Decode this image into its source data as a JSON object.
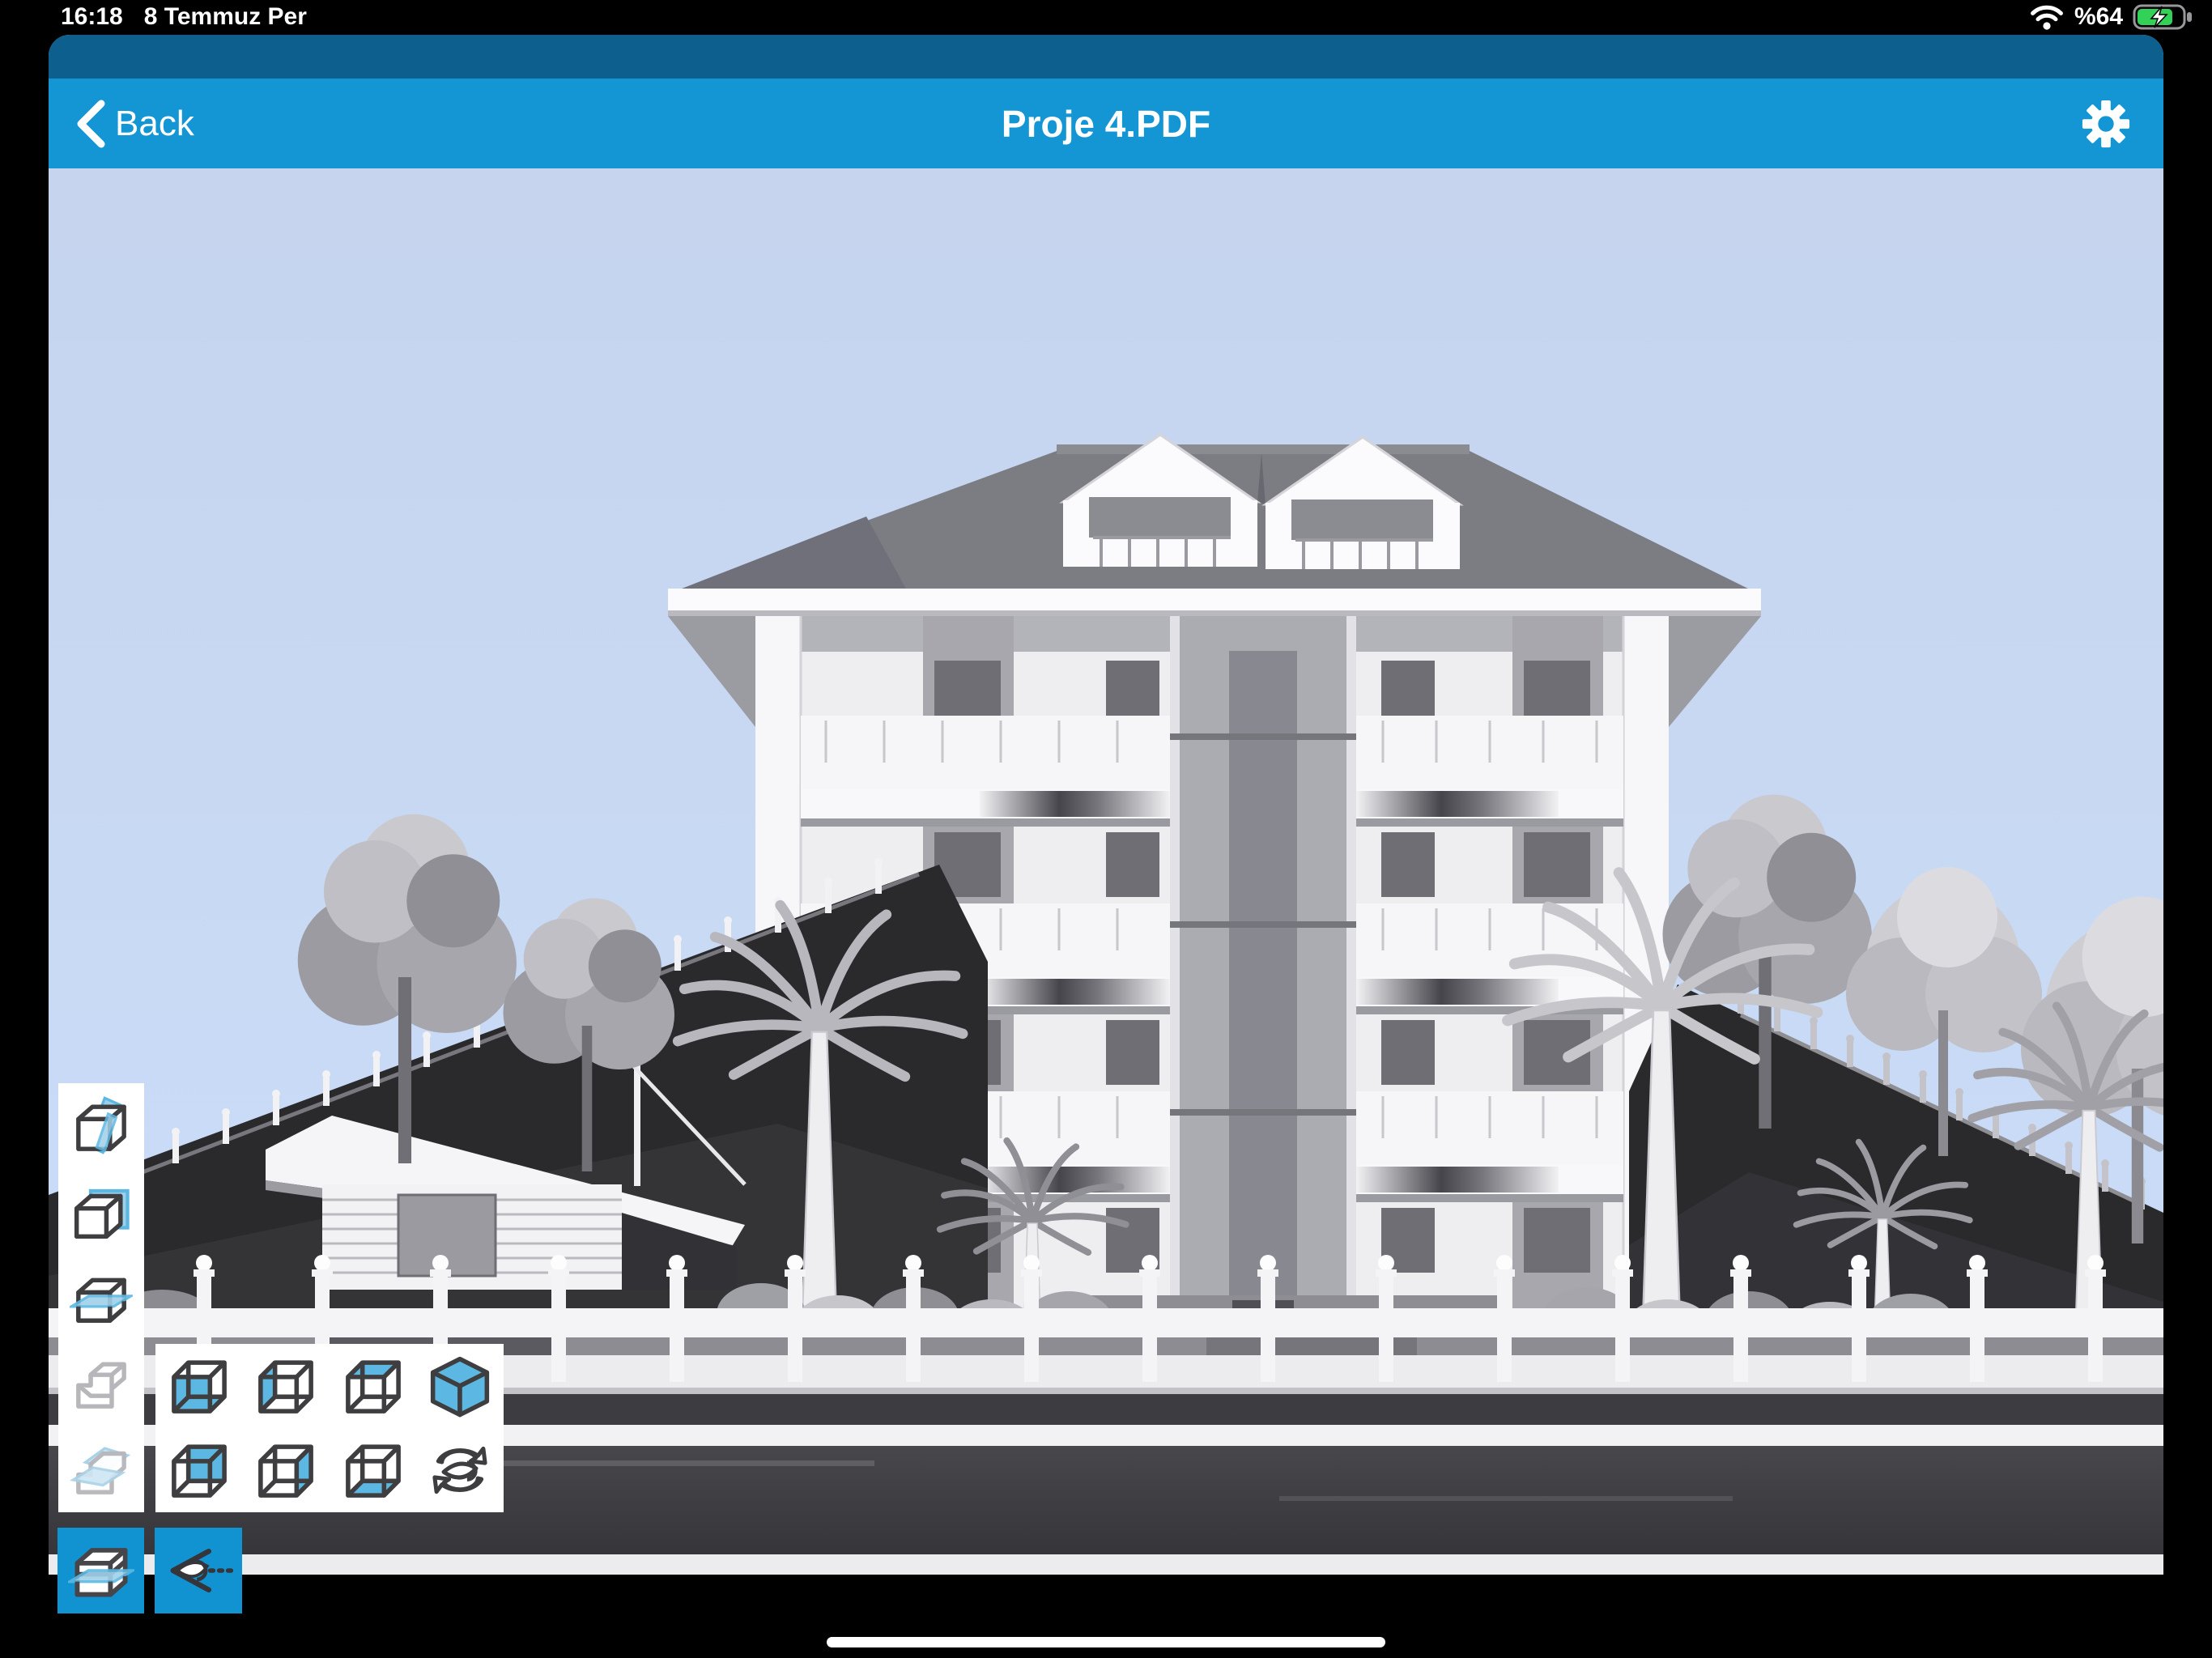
{
  "status_bar": {
    "time": "16:18",
    "date": "8 Temmuz Per",
    "battery": "%64"
  },
  "nav": {
    "back_label": "Back",
    "title": "Proje 4.PDF"
  },
  "toolbar": {
    "section_tools": [
      {
        "name": "section-box-vertical-plane",
        "disabled": false
      },
      {
        "name": "section-box-back-plane",
        "disabled": false
      },
      {
        "name": "section-box-horizontal-plane",
        "disabled": false
      },
      {
        "name": "section-stepped-box",
        "disabled": true
      },
      {
        "name": "section-stepped-box-planes",
        "disabled": true
      }
    ],
    "view_tools": [
      {
        "name": "view-front"
      },
      {
        "name": "view-left"
      },
      {
        "name": "view-top"
      },
      {
        "name": "view-isometric"
      },
      {
        "name": "view-back"
      },
      {
        "name": "view-right"
      },
      {
        "name": "view-bottom"
      },
      {
        "name": "view-orbit"
      }
    ],
    "active_tools": [
      {
        "name": "section-slab-tool"
      },
      {
        "name": "hide-view-tool"
      }
    ]
  },
  "scene": {
    "type": "3d-architectural-model-render"
  },
  "colors": {
    "nav_blue": "#1496d4",
    "nav_dark_blue": "#0d5f8e",
    "accent_blue": "#5cb8e2",
    "sky_blue": "#cadef9",
    "battery_green": "#32d158",
    "toolbar_bg": "#ffffff"
  }
}
